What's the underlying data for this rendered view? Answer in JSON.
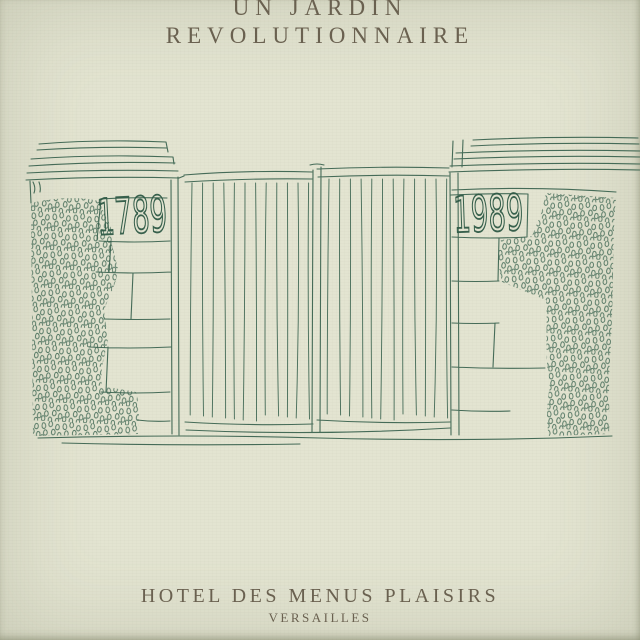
{
  "poster": {
    "title_line1": "UN JARDIN",
    "title_line2": "REVOLUTIONNAIRE",
    "footer_line1": "HOTEL DES MENUS PLAISIRS",
    "footer_line2": "VERSAILLES"
  },
  "drawing": {
    "description": "hand-drawn pen sketch of a garden gate between two ivy-covered stone pillars",
    "left_pillar_year": "1789",
    "right_pillar_year": "1989"
  },
  "colors": {
    "paper_background": "#e3e4d1",
    "ink_green": "#37614d",
    "title_text": "#6a6150"
  }
}
